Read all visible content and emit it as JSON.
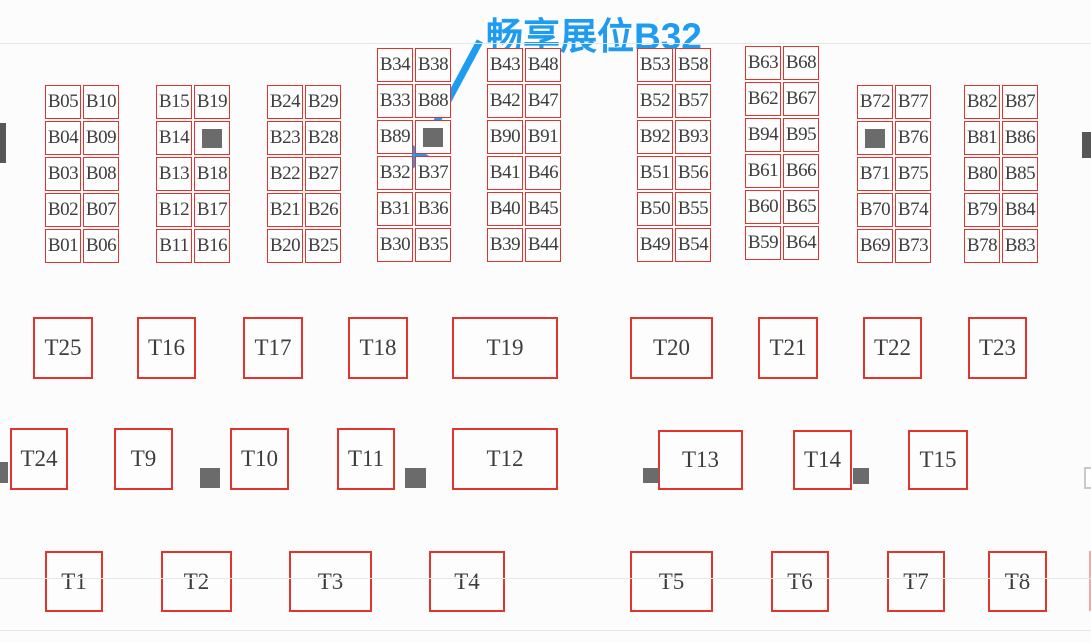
{
  "annotation": {
    "label": "畅享展位B32",
    "target_booth": "B32"
  },
  "colors": {
    "border": "#e2342e",
    "text": "#3d3d3d",
    "annotation": "#1d9cf1",
    "block": "#6b6b6b",
    "edge": "#575757",
    "scanline": "#e7e7e7"
  },
  "b_groups": [
    {
      "x": 45,
      "y": 85,
      "rows": [
        [
          "B05",
          "B10"
        ],
        [
          "B04",
          "B09"
        ],
        [
          "B03",
          "B08"
        ],
        [
          "B02",
          "B07"
        ],
        [
          "B01",
          "B06"
        ]
      ]
    },
    {
      "x": 156,
      "y": 85,
      "rows": [
        [
          "B15",
          "B19"
        ],
        [
          "B14",
          "■"
        ],
        [
          "B13",
          "B18"
        ],
        [
          "B12",
          "B17"
        ],
        [
          "B11",
          "B16"
        ]
      ]
    },
    {
      "x": 267,
      "y": 85,
      "rows": [
        [
          "B24",
          "B29"
        ],
        [
          "B23",
          "B28"
        ],
        [
          "B22",
          "B27"
        ],
        [
          "B21",
          "B26"
        ],
        [
          "B20",
          "B25"
        ]
      ]
    },
    {
      "x": 377,
      "y": 48,
      "rows": [
        [
          "B34",
          "B38"
        ],
        [
          "B33",
          "B88"
        ],
        [
          "B89",
          "■"
        ],
        [
          "B32",
          "B37"
        ],
        [
          "B31",
          "B36"
        ],
        [
          "B30",
          "B35"
        ]
      ]
    },
    {
      "x": 487,
      "y": 48,
      "rows": [
        [
          "B43",
          "B48"
        ],
        [
          "B42",
          "B47"
        ],
        [
          "B90",
          "B91"
        ],
        [
          "B41",
          "B46"
        ],
        [
          "B40",
          "B45"
        ],
        [
          "B39",
          "B44"
        ]
      ]
    },
    {
      "x": 637,
      "y": 48,
      "rows": [
        [
          "B53",
          "B58"
        ],
        [
          "B52",
          "B57"
        ],
        [
          "B92",
          "B93"
        ],
        [
          "B51",
          "B56"
        ],
        [
          "B50",
          "B55"
        ],
        [
          "B49",
          "B54"
        ]
      ]
    },
    {
      "x": 745,
      "y": 46,
      "rows": [
        [
          "B63",
          "B68"
        ],
        [
          "B62",
          "B67"
        ],
        [
          "B94",
          "B95"
        ],
        [
          "B61",
          "B66"
        ],
        [
          "B60",
          "B65"
        ],
        [
          "B59",
          "B64"
        ]
      ]
    },
    {
      "x": 857,
      "y": 85,
      "rows": [
        [
          "B72",
          "B77"
        ],
        [
          "■",
          "B76"
        ],
        [
          "B71",
          "B75"
        ],
        [
          "B70",
          "B74"
        ],
        [
          "B69",
          "B73"
        ]
      ]
    },
    {
      "x": 964,
      "y": 85,
      "rows": [
        [
          "B82",
          "B87"
        ],
        [
          "B81",
          "B86"
        ],
        [
          "B80",
          "B85"
        ],
        [
          "B79",
          "B84"
        ],
        [
          "B78",
          "B83"
        ]
      ]
    }
  ],
  "t_booths": [
    {
      "label": "T25",
      "x": 33,
      "y": 317,
      "w": 60,
      "h": 62
    },
    {
      "label": "T16",
      "x": 137,
      "y": 317,
      "w": 59,
      "h": 62
    },
    {
      "label": "T17",
      "x": 243,
      "y": 317,
      "w": 60,
      "h": 62
    },
    {
      "label": "T18",
      "x": 348,
      "y": 317,
      "w": 60,
      "h": 62
    },
    {
      "label": "T19",
      "x": 452,
      "y": 317,
      "w": 106,
      "h": 62
    },
    {
      "label": "T20",
      "x": 630,
      "y": 317,
      "w": 83,
      "h": 62
    },
    {
      "label": "T21",
      "x": 758,
      "y": 317,
      "w": 60,
      "h": 62
    },
    {
      "label": "T22",
      "x": 863,
      "y": 317,
      "w": 59,
      "h": 62
    },
    {
      "label": "T23",
      "x": 968,
      "y": 317,
      "w": 59,
      "h": 62
    },
    {
      "label": "T24",
      "x": 10,
      "y": 428,
      "w": 58,
      "h": 62
    },
    {
      "label": "T9",
      "x": 114,
      "y": 428,
      "w": 59,
      "h": 62
    },
    {
      "label": "T10",
      "x": 230,
      "y": 428,
      "w": 59,
      "h": 62
    },
    {
      "label": "T11",
      "x": 337,
      "y": 428,
      "w": 58,
      "h": 62
    },
    {
      "label": "T12",
      "x": 452,
      "y": 428,
      "w": 106,
      "h": 62
    },
    {
      "label": "T13",
      "x": 658,
      "y": 430,
      "w": 85,
      "h": 60
    },
    {
      "label": "T14",
      "x": 793,
      "y": 430,
      "w": 59,
      "h": 60
    },
    {
      "label": "T15",
      "x": 908,
      "y": 430,
      "w": 60,
      "h": 60
    },
    {
      "label": "T1",
      "x": 45,
      "y": 551,
      "w": 58,
      "h": 61
    },
    {
      "label": "T2",
      "x": 161,
      "y": 551,
      "w": 71,
      "h": 61
    },
    {
      "label": "T3",
      "x": 289,
      "y": 551,
      "w": 83,
      "h": 61
    },
    {
      "label": "T4",
      "x": 429,
      "y": 551,
      "w": 76,
      "h": 61
    },
    {
      "label": "T5",
      "x": 630,
      "y": 551,
      "w": 83,
      "h": 61
    },
    {
      "label": "T6",
      "x": 771,
      "y": 551,
      "w": 58,
      "h": 61
    },
    {
      "label": "T7",
      "x": 887,
      "y": 551,
      "w": 58,
      "h": 61
    },
    {
      "label": "T8",
      "x": 988,
      "y": 551,
      "w": 59,
      "h": 61
    }
  ],
  "pillars": [
    {
      "x": 200,
      "y": 468,
      "w": 20,
      "h": 20
    },
    {
      "x": 405,
      "y": 468,
      "w": 21,
      "h": 20
    },
    {
      "x": 643,
      "y": 468,
      "w": 16,
      "h": 15
    },
    {
      "x": 853,
      "y": 468,
      "w": 16,
      "h": 16
    },
    {
      "x": 0,
      "y": 462,
      "w": 8,
      "h": 21
    }
  ],
  "edge_dark_marks": [
    {
      "x": 0,
      "y": 123,
      "w": 6,
      "h": 40
    },
    {
      "x": 1082,
      "y": 132,
      "w": 9,
      "h": 26
    }
  ],
  "edge_faint_marks": [
    {
      "x": 1084,
      "y": 467,
      "w": 7,
      "h": 22
    }
  ],
  "red_slivers": [
    {
      "x": 1089,
      "y": 551,
      "w": 2,
      "h": 60
    }
  ],
  "scan_lines": [
    {
      "y": 43
    },
    {
      "y": 578
    },
    {
      "y": 630
    }
  ],
  "arrow": {
    "x1": 480,
    "y1": 41,
    "x2": 421,
    "y2": 151,
    "tip": "410,171 429,156 413,145"
  }
}
